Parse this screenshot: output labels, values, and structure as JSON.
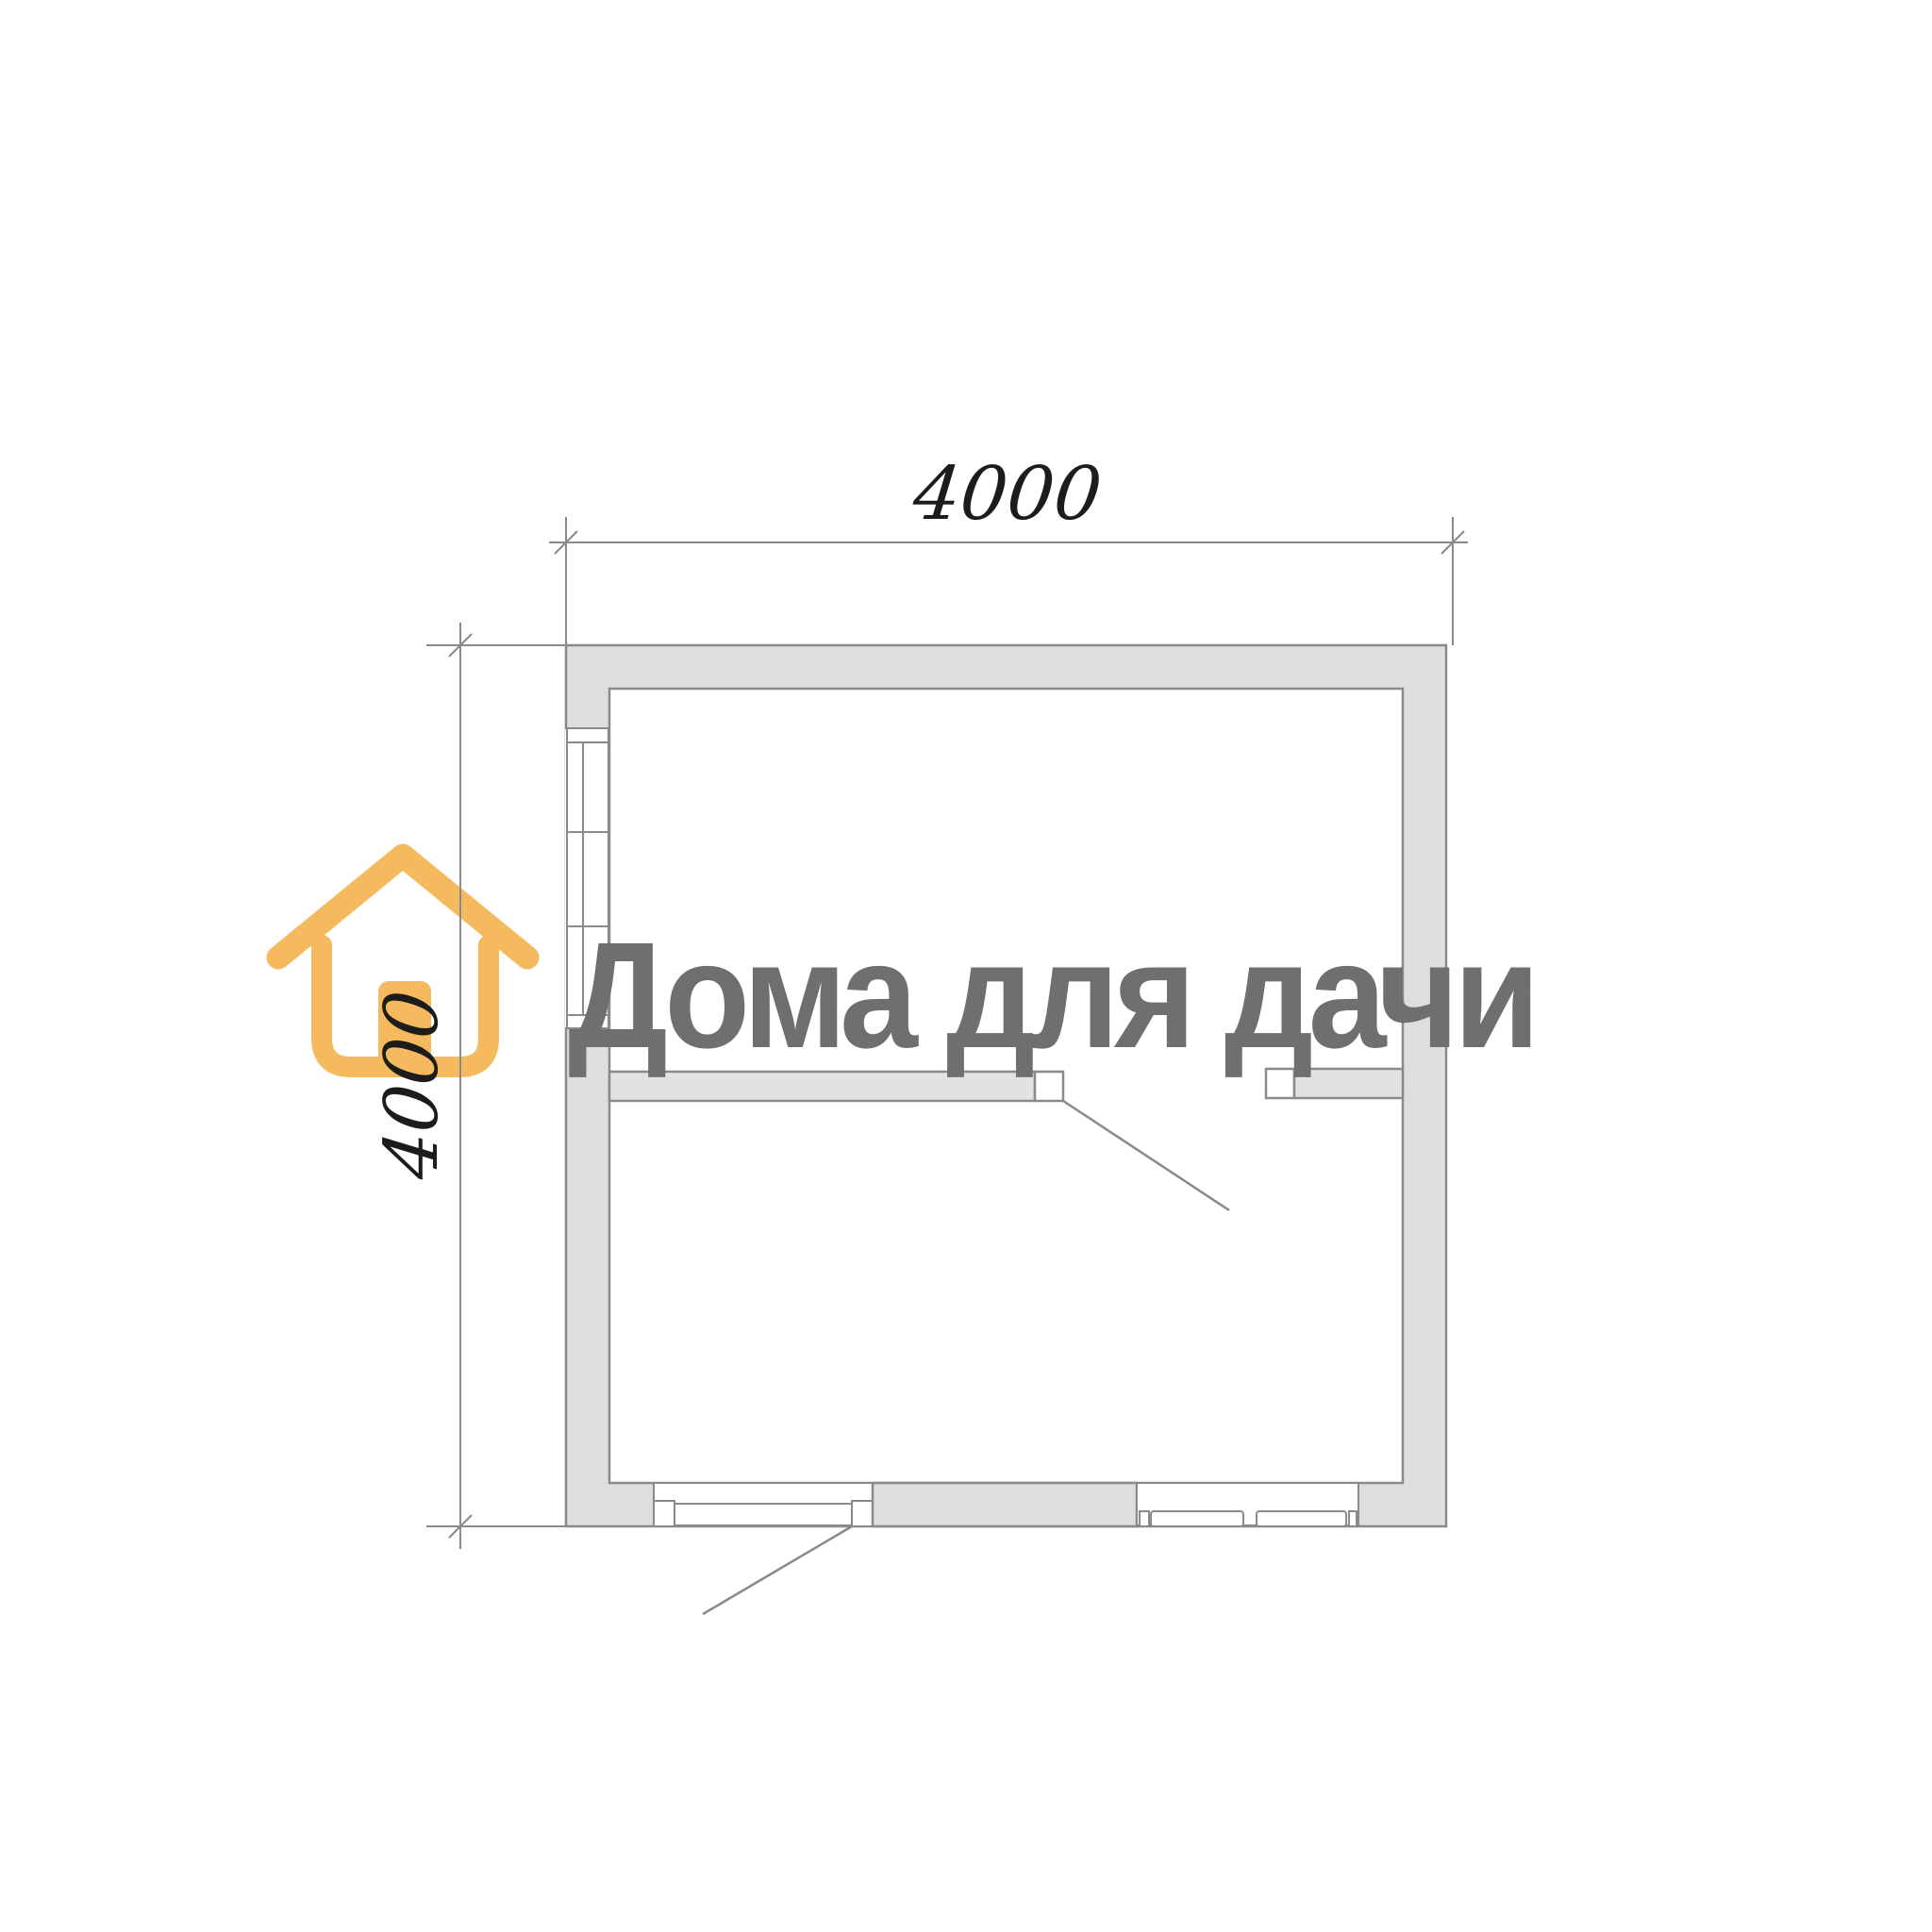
{
  "page": {
    "background": "#FFFFFF",
    "content_type": "floor-plan-drawing"
  },
  "watermark": {
    "text": "Дома для дачи",
    "color": "#6F6F6F",
    "logo_icon": "house-icon",
    "logo_color": "#F6BA5E"
  },
  "dimensions": {
    "top": {
      "label": "4000"
    },
    "left": {
      "label": "4000"
    },
    "line_color": "#8A8A8A",
    "text_color": "#1C1C1C"
  },
  "plan": {
    "wall_fill": "#DEDEDE",
    "wall_outline": "#8A8A8A",
    "rooms_visible": 2,
    "elements": [
      {
        "name": "exterior-walls",
        "shape": "square-ring"
      },
      {
        "name": "window-left-wall",
        "panes": 2
      },
      {
        "name": "entrance-door-bottom-wall",
        "swing": "outward-down-left"
      },
      {
        "name": "window-bottom-wall-right",
        "panes": 2
      },
      {
        "name": "interior-partition-wall",
        "orientation": "horizontal"
      },
      {
        "name": "interior-door",
        "swing": "into-lower-room"
      }
    ]
  }
}
